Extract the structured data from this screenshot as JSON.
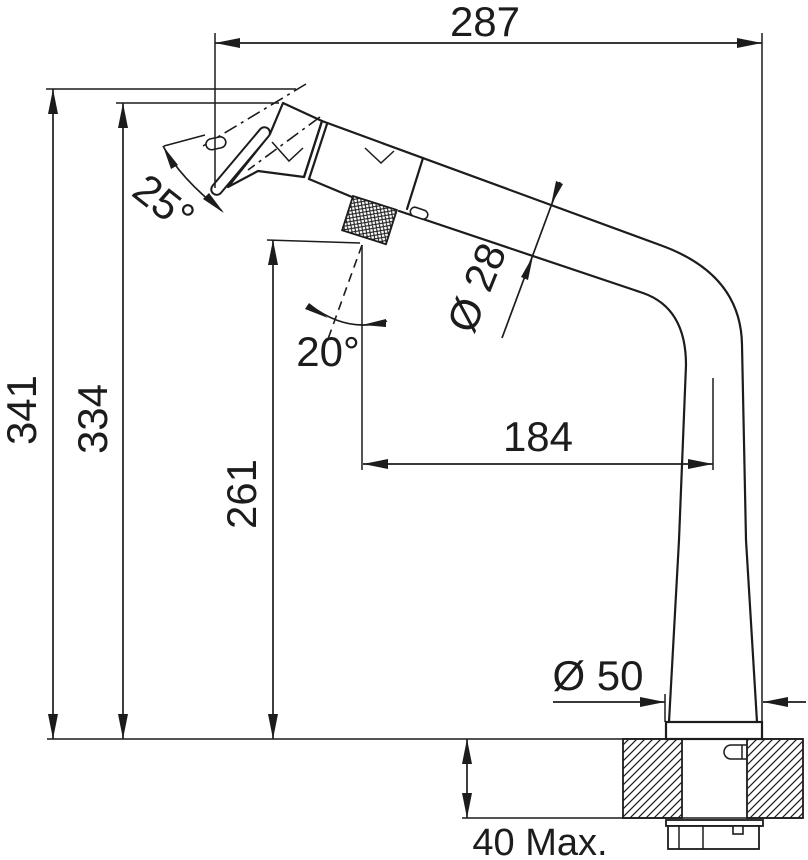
{
  "drawing": {
    "subject": "pull-out-spray-kitchen-faucet-dimension-drawing",
    "colors": {
      "line": "#1c1c1c",
      "background": "#ffffff"
    },
    "labels": {
      "width_287": "287",
      "height_341": "341",
      "height_334": "334",
      "height_261": "261",
      "reach_184": "184",
      "spout_diameter": "Ø 28",
      "base_diameter": "Ø 50",
      "head_angle": "25°",
      "swivel_angle": "20°",
      "counter_thickness": "40 Max."
    }
  }
}
